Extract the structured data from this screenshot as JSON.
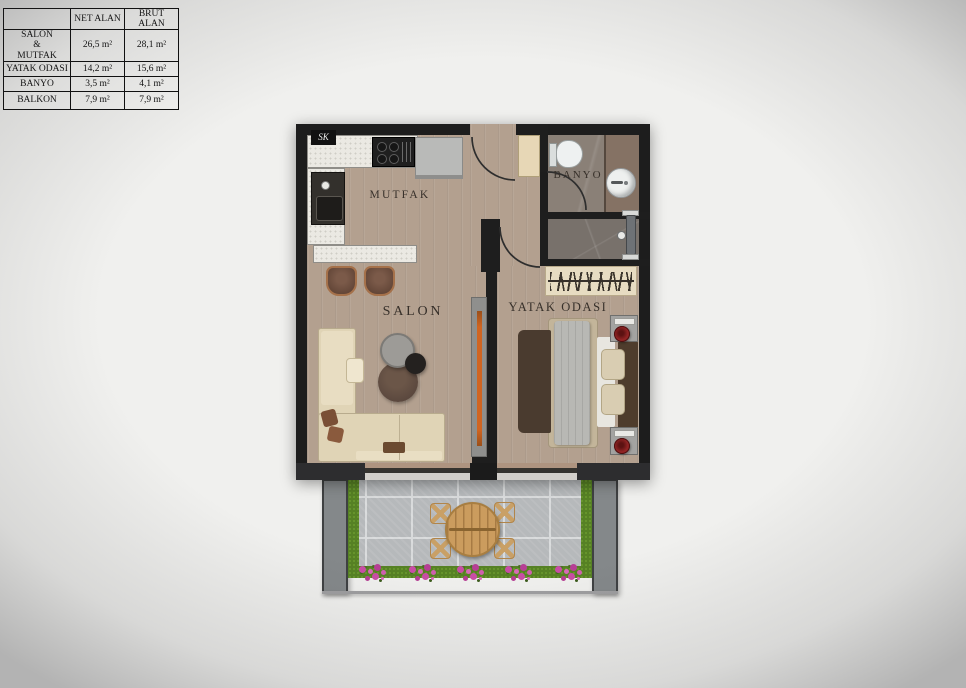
{
  "area_table": {
    "corner_header": "",
    "columns": [
      "NET ALAN",
      "BRÜT ALAN"
    ],
    "rows": [
      {
        "room": "SALON\n&\nMUTFAK",
        "net": "26,5 m²",
        "brut": "28,1 m²"
      },
      {
        "room": "YATAK ODASI",
        "net": "14,2 m²",
        "brut": "15,6 m²"
      },
      {
        "room": "BANYO",
        "net": "3,5 m²",
        "brut": "4,1 m²"
      },
      {
        "room": "BALKON",
        "net": "7,9 m²",
        "brut": "7,9 m²"
      }
    ]
  },
  "floor_plan": {
    "labels": {
      "kitchen": "MUTFAK",
      "living_room": "SALON",
      "bedroom": "YATAK ODASI",
      "bathroom": "BANYO",
      "shaft": "SK"
    },
    "colors": {
      "wall": "#1e1e1e",
      "wood_floor": "#b3a08f",
      "bathroom_floor": "#8a8077",
      "hall_floor": "#78716b",
      "balcony_tile": "#b6b9bb",
      "grass_green": "#568124",
      "flower_pink": "#c94da5",
      "accent_orange": "#d06522",
      "sofa_cream": "#e0d4b6",
      "outdoor_table_wood": "#cb9c5e"
    }
  }
}
